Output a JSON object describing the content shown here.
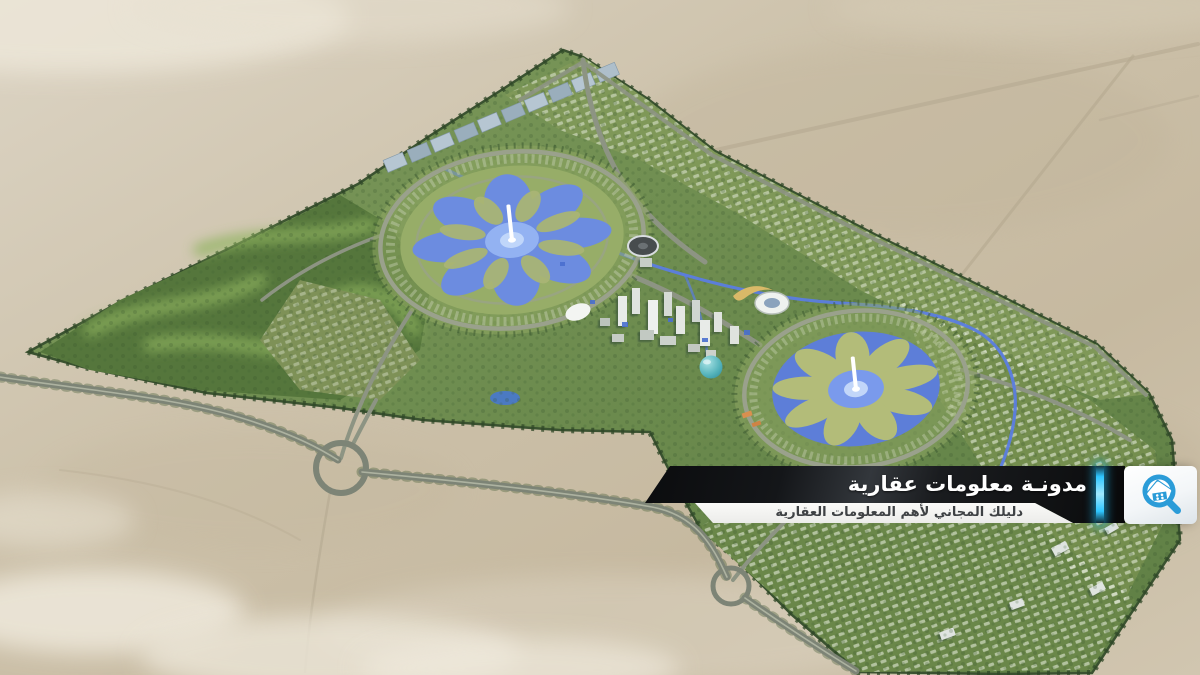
{
  "overlay": {
    "title": "مدونـة معلومات عقارية",
    "subtitle": "دليلك المجاني لأهم المعلومات العقارية",
    "accent_color": "#2ec6ff",
    "title_bar_color": "#17191d",
    "title_text_color": "#ffffff",
    "subtitle_bar_color": "#f2f2f0",
    "subtitle_text_color": "#3e4144",
    "logo": {
      "icon": "house-magnifier-icon",
      "icon_color": "#2b9cd8",
      "card_color": "#ffffff"
    }
  },
  "scene": {
    "description": "aerial 3D render of a master-planned city surrounded by desert",
    "elements": [
      "desert",
      "golf-course-district",
      "flower-lake-park-west",
      "flower-lake-park-east",
      "central-business-district-towers",
      "stadium",
      "canal",
      "solar-panel-strip",
      "residential-districts",
      "highway-with-loop-interchanges",
      "clouds"
    ],
    "palette": {
      "desert": "#cdc2ab",
      "city_green": "#6e8b50",
      "lake_blue": "#6c8ce0",
      "road_gray": "#8d9483",
      "tree_green": "#33512b"
    }
  }
}
